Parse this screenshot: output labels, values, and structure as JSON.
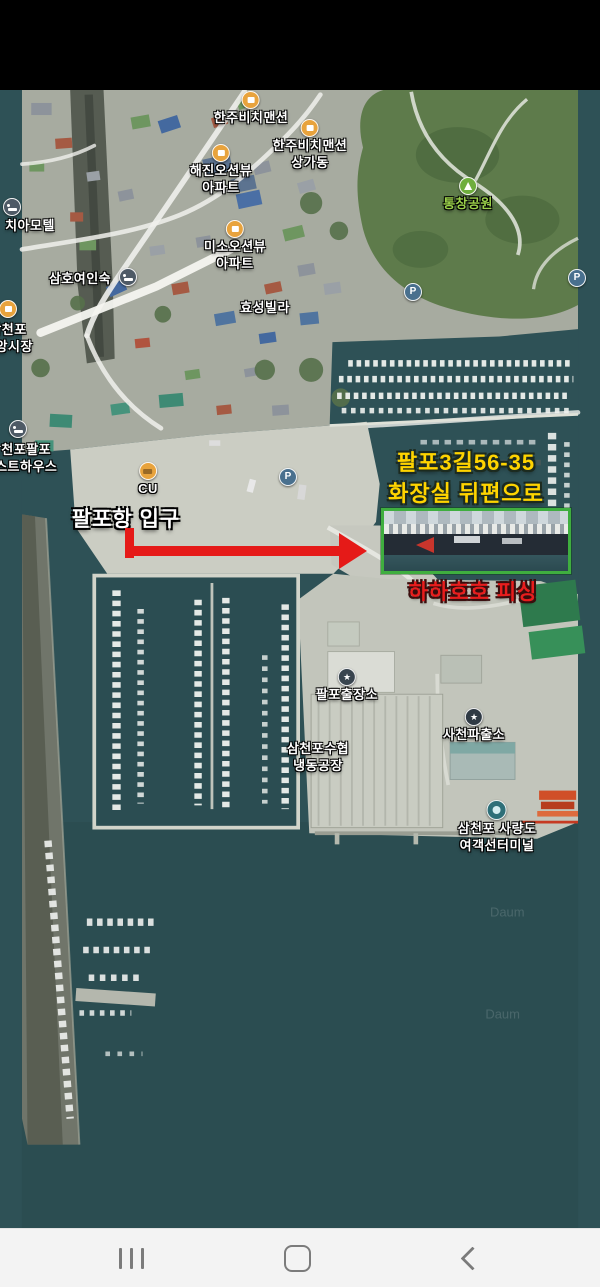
{
  "map": {
    "pois": [
      {
        "id": "hanju-beach-mansion",
        "icon": "building",
        "x": 251,
        "y": 91,
        "lines": [
          "한주비치맨션"
        ]
      },
      {
        "id": "hanju-beach-mansion-sangga",
        "icon": "building",
        "x": 310,
        "y": 119,
        "lines": [
          "한주비치맨션",
          "상가동"
        ]
      },
      {
        "id": "haejin-oceanview-apt",
        "icon": "building",
        "x": 221,
        "y": 144,
        "lines": [
          "해진오션뷰",
          "아파트"
        ]
      },
      {
        "id": "tongchang-park",
        "icon": "tree",
        "x": 468,
        "y": 177,
        "green": true,
        "lines": [
          "통창공원"
        ]
      },
      {
        "id": "chia-motel-icon",
        "icon": "bed",
        "x": 12,
        "y": 198,
        "lines": []
      },
      {
        "id": "chia-motel",
        "x": 30,
        "y": 218,
        "lines": [
          "치아모텔"
        ]
      },
      {
        "id": "samho-inn",
        "x": 80,
        "y": 271,
        "lines": [
          "삼호여인숙"
        ]
      },
      {
        "id": "samho-inn-icon",
        "icon": "bed",
        "x": 128,
        "y": 268,
        "lines": []
      },
      {
        "id": "jungang-market-icon",
        "icon": "market",
        "x": 8,
        "y": 300,
        "lines": []
      },
      {
        "id": "jungang-market",
        "x": 8,
        "y": 322,
        "lines": [
          "삼천포",
          "중앙시장"
        ]
      },
      {
        "id": "miso-oceanview-apt",
        "icon": "building",
        "x": 235,
        "y": 220,
        "lines": [
          "미소오션뷰",
          "아파트"
        ]
      },
      {
        "id": "hyosung-villa",
        "x": 265,
        "y": 300,
        "lines": [
          "효성빌라"
        ]
      },
      {
        "id": "palpo-guesthouse-icon",
        "icon": "bed",
        "x": 18,
        "y": 420,
        "lines": []
      },
      {
        "id": "palpo-guesthouse",
        "x": 20,
        "y": 442,
        "lines": [
          "삼천포팔포",
          "게스트하우스"
        ]
      },
      {
        "id": "cu-store",
        "icon": "cu",
        "x": 148,
        "y": 462,
        "lines": [
          "CU"
        ]
      },
      {
        "id": "parking-lot",
        "icon": "parking",
        "x": 288,
        "y": 468,
        "lines": []
      },
      {
        "id": "parking-hill-1",
        "icon": "parking",
        "x": 413,
        "y": 283,
        "lines": []
      },
      {
        "id": "parking-hill-2",
        "icon": "parking",
        "x": 577,
        "y": 269,
        "lines": []
      },
      {
        "id": "palpo-branch-office",
        "icon": "gov",
        "x": 347,
        "y": 668,
        "lines": [
          "팔포출장소"
        ]
      },
      {
        "id": "suhyup-cold-storage",
        "x": 318,
        "y": 741,
        "lines": [
          "삼천포수협",
          "냉동공장"
        ]
      },
      {
        "id": "sacheon-police-box",
        "icon": "police",
        "x": 474,
        "y": 708,
        "lines": [
          "사천파출소"
        ]
      },
      {
        "id": "ferry-terminal",
        "icon": "ferry",
        "x": 497,
        "y": 800,
        "lines": [
          "삼천포 사량도",
          "여객선터미널"
        ]
      }
    ],
    "annotations": {
      "address_line1": "팔포3길56-35",
      "address_line2": "화장실 뒤편으로",
      "entrance": "팔포항 입구",
      "shop": "하하호호 피싱"
    },
    "watermark": "Daum",
    "colors": {
      "annotation_yellow": "#ffd400",
      "annotation_red": "#e81d1d",
      "highlight_green": "#3fae3f",
      "arrow_red": "#e51a18",
      "water": "#2e5156",
      "concrete": "#cbcdc3"
    }
  },
  "nav_bar": {
    "icons": [
      {
        "name": "recents"
      },
      {
        "name": "home"
      },
      {
        "name": "back"
      }
    ]
  }
}
